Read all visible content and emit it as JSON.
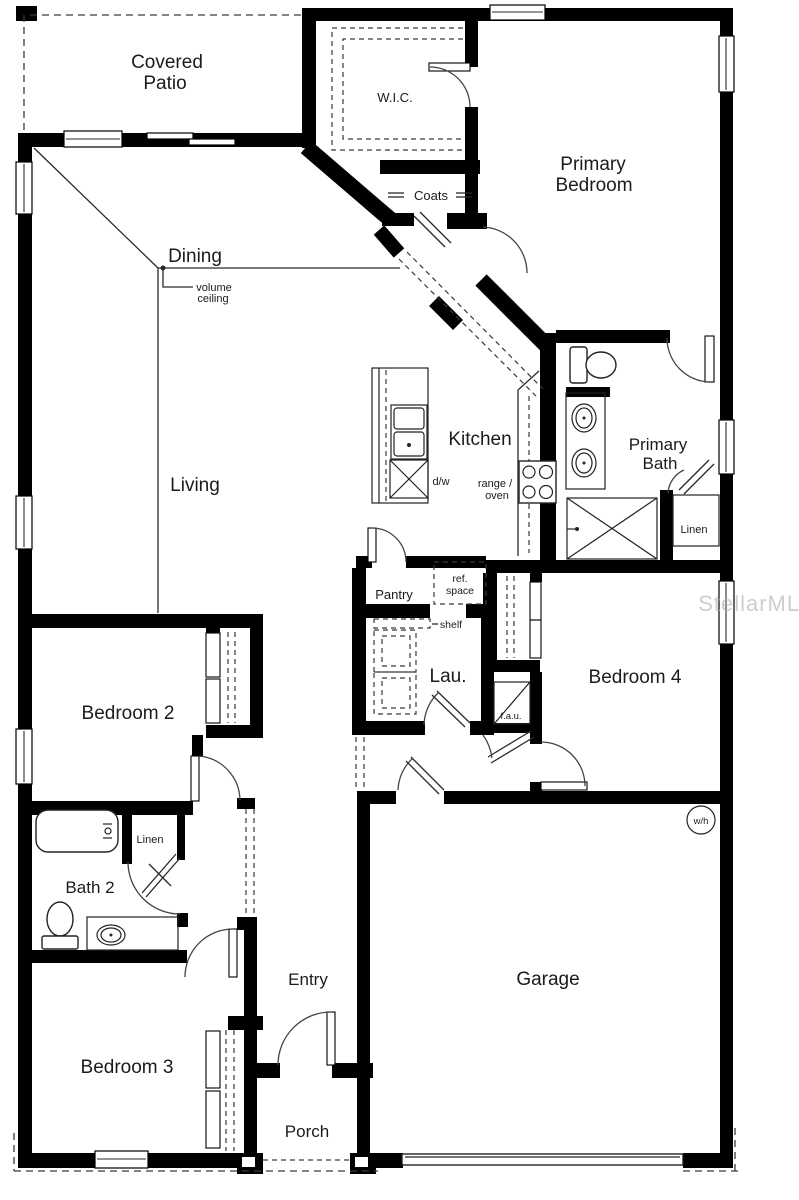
{
  "colors": {
    "wall": "#000000",
    "line": "#2a2a2a",
    "background": "#ffffff",
    "watermark": "#a9aeb4"
  },
  "labels": {
    "covered_patio": [
      "Covered",
      "Patio"
    ],
    "wic": "W.I.C.",
    "primary_bedroom": [
      "Primary",
      "Bedroom"
    ],
    "coats": "Coats",
    "dining": "Dining",
    "volume_ceiling": [
      "volume",
      "ceiling"
    ],
    "living": "Living",
    "kitchen": "Kitchen",
    "dishwasher": "d/w",
    "range_oven": [
      "range /",
      "oven"
    ],
    "primary_bath": [
      "Primary",
      "Bath"
    ],
    "linen_primary": "Linen",
    "pantry": "Pantry",
    "ref_space": [
      "ref.",
      "space"
    ],
    "shelf": "shelf",
    "laundry": "Lau.",
    "fau": "f.a.u.",
    "bedroom4": "Bedroom 4",
    "bedroom2": "Bedroom 2",
    "linen_hall": "Linen",
    "bath2": "Bath 2",
    "bedroom3": "Bedroom 3",
    "entry": "Entry",
    "porch": "Porch",
    "garage": "Garage",
    "water_heater": "w/h",
    "watermark": "StellarMLS"
  }
}
